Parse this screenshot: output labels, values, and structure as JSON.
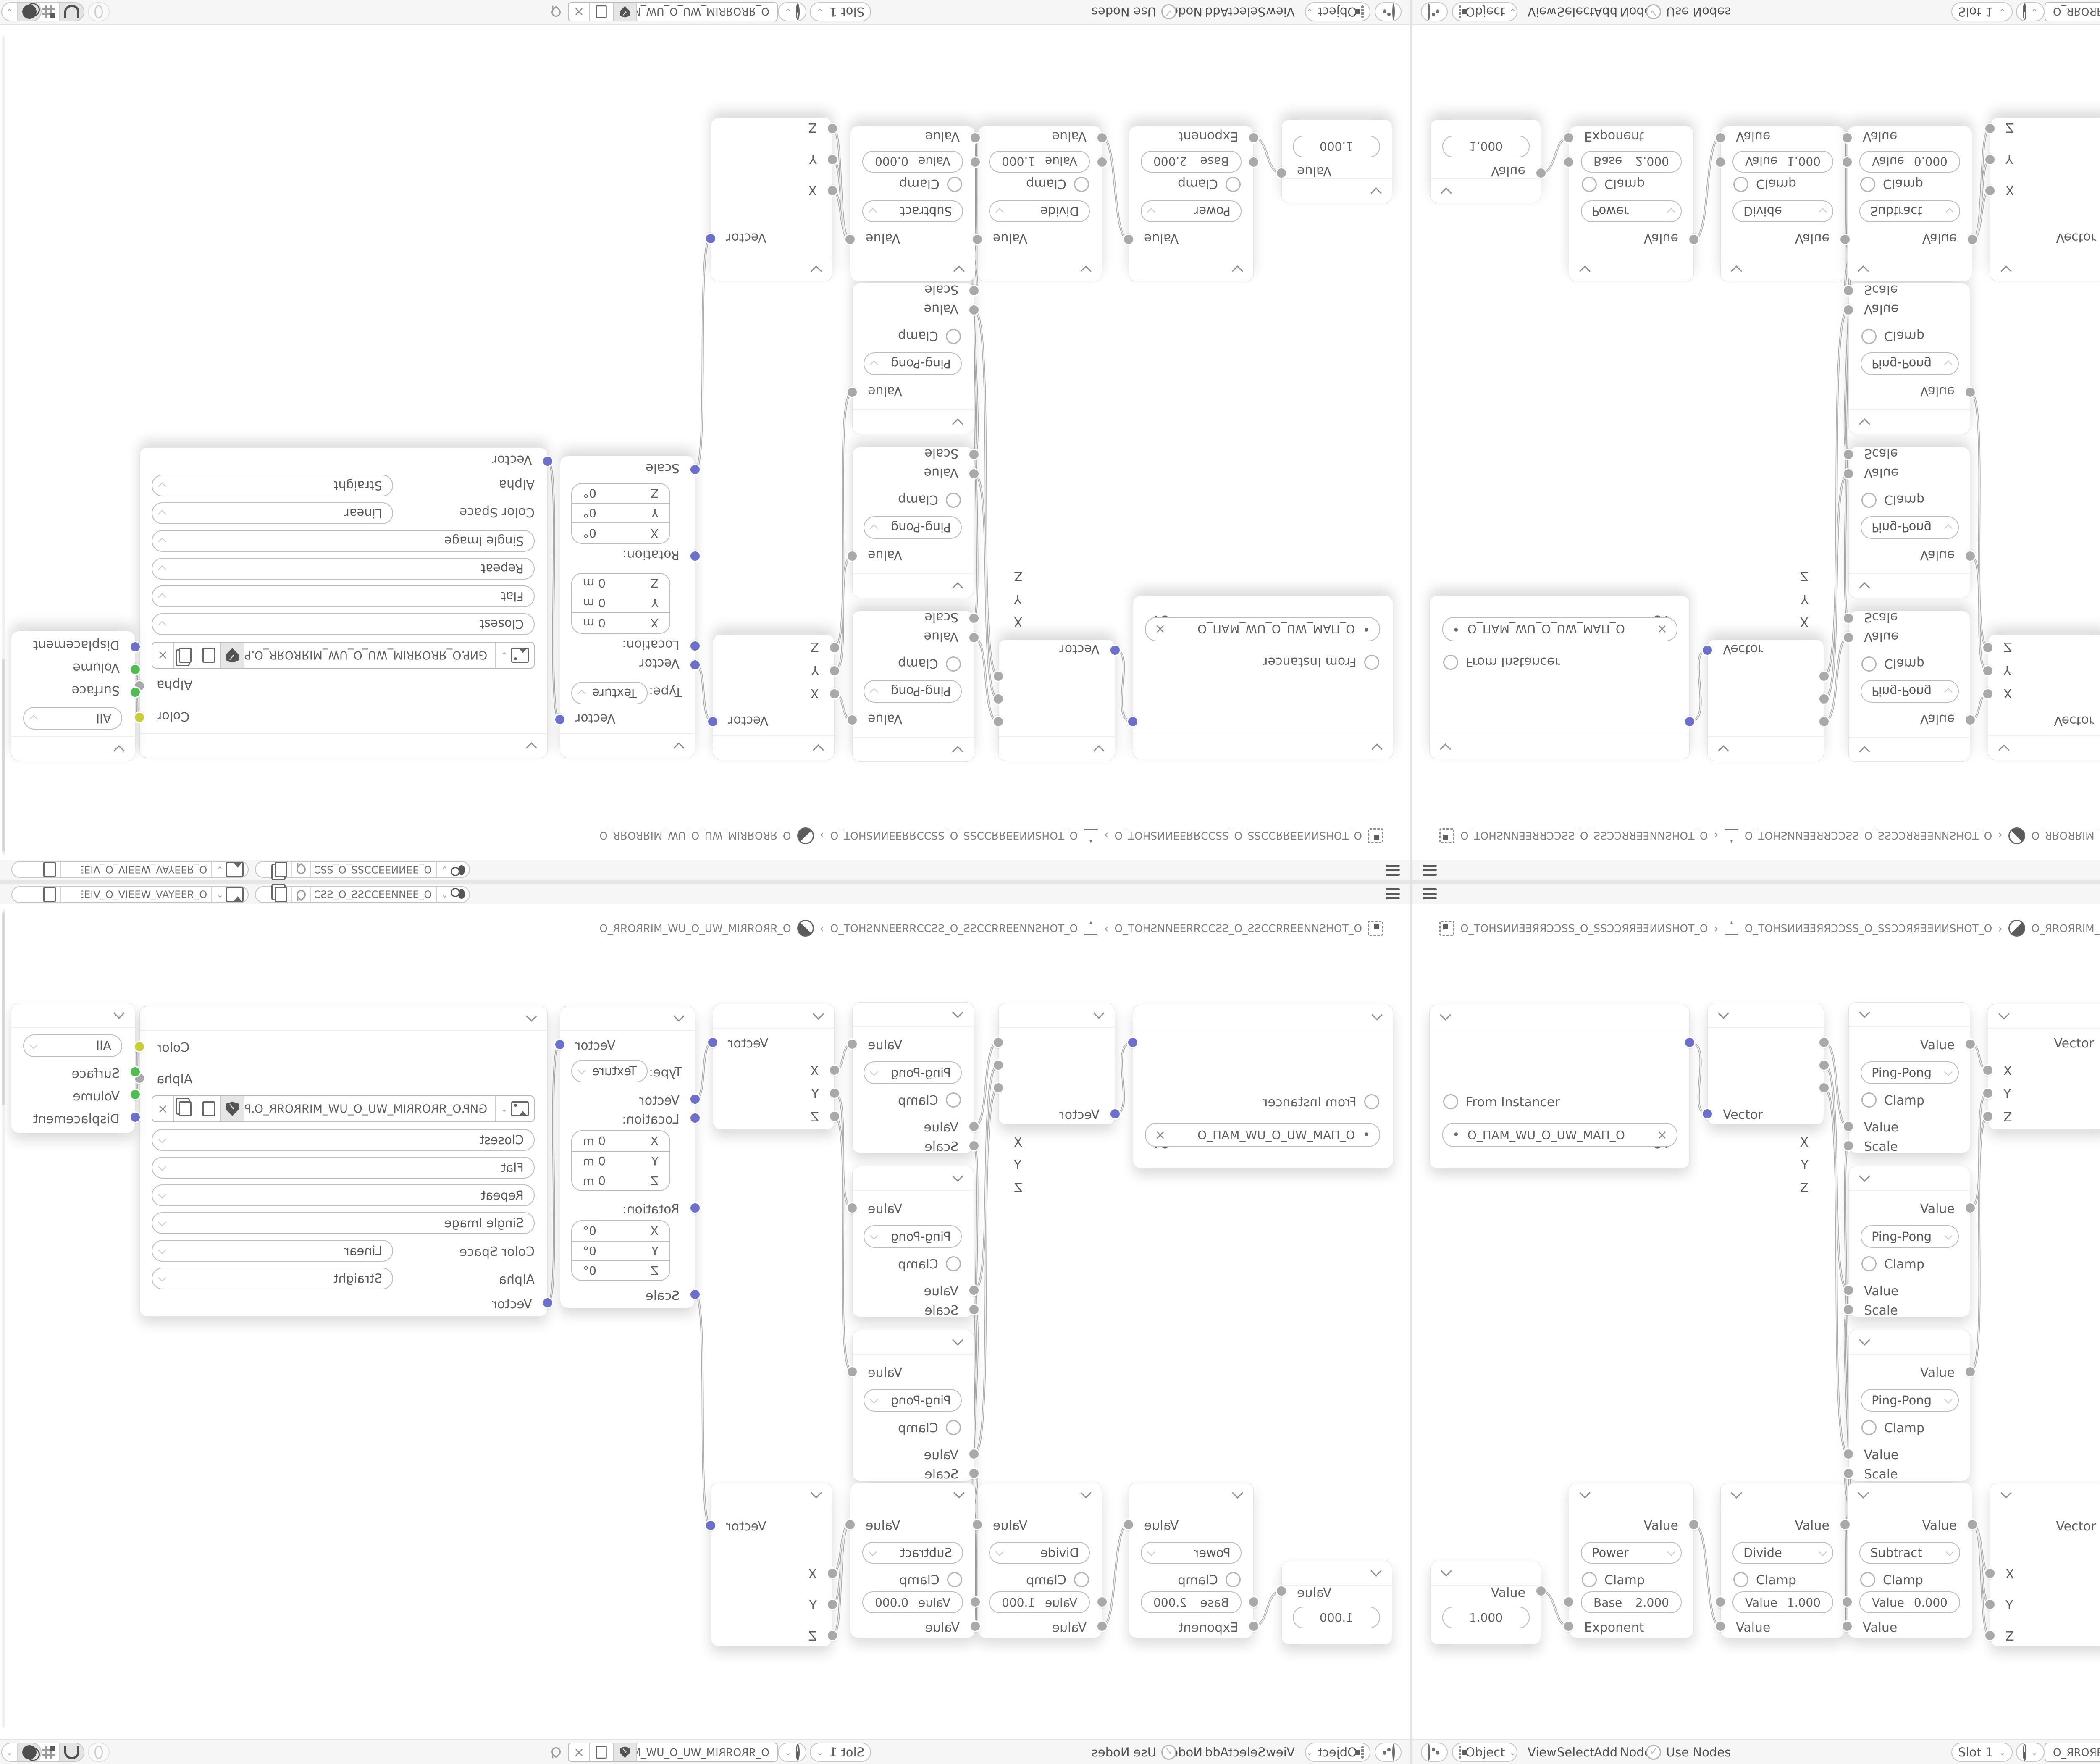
{
  "colors": {
    "socket_vector": "#6d70c8",
    "socket_value": "#a9a9a9",
    "socket_shader": "#51bb54",
    "socket_color_out": "#c9cd3d",
    "wire": "#b0b0b0",
    "bar_bg": "#f6f6f6",
    "canvas_bg": "#ffffff"
  },
  "topbar": {
    "scene": {
      "value": "O_ƎƎИИƎƎƆƆSS_O_SSƆƆƎƎИИ…"
    },
    "view_layer": {
      "value": "O_ЯƎƎYAV_WƎƎIV_O_VIƎƎW_VAYƎƎЯ_O"
    }
  },
  "breadcrumb": {
    "object": "O_TOHSИИƎƎЯЯƆƆSS_O_SSƆƆЯЯƎƎИИSHOT_O",
    "mesh": "O_TOHSИИƎƎЯЯƆƆSS_O_SSƆƆЯЯƎƎИИSHOT_O",
    "material": "O_ЯROЯRIM_WU_O_UW_MIЯROЯR_O",
    "sep": "›"
  },
  "nodes": {
    "uv_map": {
      "output": "UV",
      "from_instancer": "From Instancer",
      "uv_name": "O_ПAM_WU_O_UW_MAП_O",
      "dot": "•",
      "clear": "×"
    },
    "separate_xyz": {
      "outputs": [
        "X",
        "Y",
        "Z"
      ],
      "input": "Vector"
    },
    "ping_pong": {
      "output": "Value",
      "operation": "Ping-Pong",
      "clamp": "Clamp",
      "input_value": "Value",
      "input_scale": "Scale"
    },
    "combine_xyz": {
      "output": "Vector",
      "inputs": [
        "X",
        "Y",
        "Z"
      ]
    },
    "mapping": {
      "output": "Vector",
      "type_label": "Type:",
      "type_value": "Texture",
      "input": "Vector",
      "location_label": "Location:",
      "rotation_label": "Rotation:",
      "scale_label": "Scale",
      "axes": [
        "X",
        "Y",
        "Z"
      ],
      "location_values": [
        "0 m",
        "0 m",
        "0 m"
      ],
      "rotation_values": [
        "0°",
        "0°",
        "0°"
      ]
    },
    "image_texture": {
      "output_color": "Color",
      "output_alpha": "Alpha",
      "image_name": "GИP.O_ЯROЯRIM_WU_O_UW_MIЯROЯR_O.PNG",
      "interpolation": "Closest",
      "projection": "Flat",
      "extension": "Repeat",
      "source": "Single Image",
      "color_space_label": "Color Space",
      "color_space": "Linear",
      "alpha_label": "Alpha",
      "alpha_mode": "Straight",
      "input": "Vector",
      "clear": "×"
    },
    "material_output": {
      "target": "All",
      "inputs": [
        "Surface",
        "Volume",
        "Displacement"
      ]
    },
    "value_node": {
      "output": "Value",
      "value": "1.000"
    },
    "power": {
      "output": "Value",
      "operation": "Power",
      "clamp": "Clamp",
      "field_label": "Base",
      "field_value": "2.000",
      "input": "Exponent"
    },
    "divide": {
      "output": "Value",
      "operation": "Divide",
      "clamp": "Clamp",
      "field_label": "Value",
      "field_value": "1.000",
      "input": "Value"
    },
    "subtract": {
      "output": "Value",
      "operation": "Subtract",
      "clamp": "Clamp",
      "field_label": "Value",
      "field_value": "0.000",
      "input": "Value"
    }
  },
  "editor_header": {
    "mode": "Object",
    "menus": [
      "View",
      "Select",
      "Add",
      "Node"
    ],
    "use_nodes": "Use Nodes",
    "slot": "Slot 1",
    "material": "O_ЯROЯRIM_WU_O_UW_MIЯROЯR_O",
    "clear": "×"
  },
  "icons": {
    "hamburger-icon": "≡",
    "scene-icon": "ball+clock shapes",
    "view-layer-icon": "photo frame",
    "pin-icon": "pushpin",
    "copy-icon": "page",
    "duplicate-icon": "stacked pages",
    "shield-icon": "fake-user shield with check",
    "image-icon": "picture frame",
    "material-icon": "half-shaded sphere",
    "object-icon": "dashed square",
    "mesh-data-icon": "triangle with vertices",
    "close-icon": "×",
    "checkbox-circle": "round checkbox",
    "magnet-icon": "snapping magnet",
    "grid-icon": "snap target grid",
    "overlay-icon": "two circles",
    "shader-editor-icon": "node circle"
  }
}
